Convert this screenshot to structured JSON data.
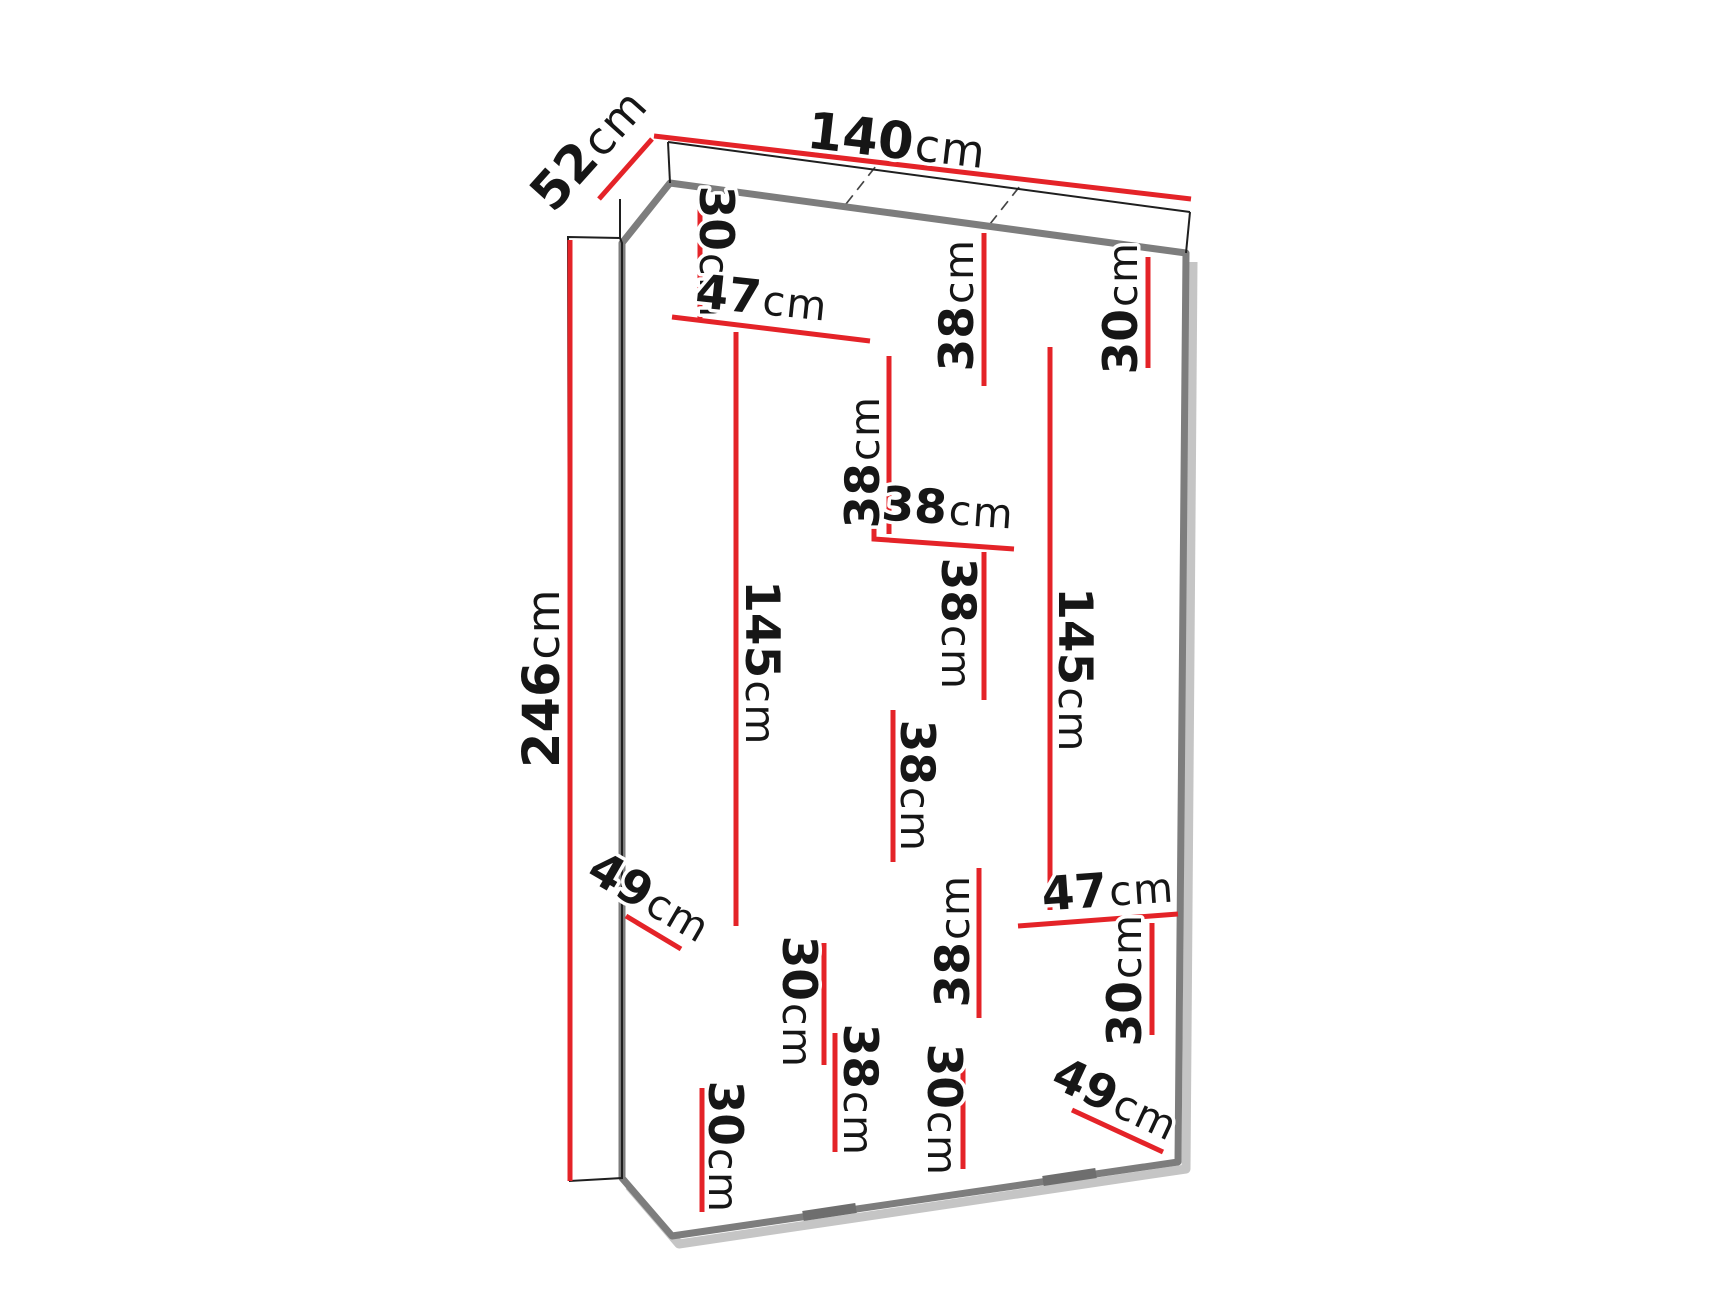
{
  "diagram": {
    "type": "furniture-dimension-drawing",
    "subject": "three-door wardrobe with interior shelving, front perspective view",
    "units": "cm",
    "overall": {
      "width": "140cm",
      "depth": "52cm",
      "height": "246cm"
    }
  },
  "colors": {
    "dimension_red": "#e42328",
    "outline_gray": "#7d7d7d",
    "dashed_gray": "#454545",
    "background": "#ffffff",
    "text": "#161616"
  },
  "dims": [
    {
      "name": "top-depth",
      "value": "52",
      "unit": "cm"
    },
    {
      "name": "top-width",
      "value": "140",
      "unit": "cm"
    },
    {
      "name": "overall-height",
      "value": "246",
      "unit": "cm"
    },
    {
      "name": "left-top-compartment-height",
      "value": "30",
      "unit": "cm"
    },
    {
      "name": "left-shelf-width",
      "value": "47",
      "unit": "cm"
    },
    {
      "name": "mid-top-compartment-height",
      "value": "38",
      "unit": "cm"
    },
    {
      "name": "right-top-compartment-height",
      "value": "30",
      "unit": "cm"
    },
    {
      "name": "mid-upper-compartment-height",
      "value": "38",
      "unit": "cm"
    },
    {
      "name": "mid-shelf-width",
      "value": "38",
      "unit": "cm"
    },
    {
      "name": "mid-middle-compartment-height",
      "value": "38",
      "unit": "cm"
    },
    {
      "name": "mid-lower-compartment-height",
      "value": "38",
      "unit": "cm"
    },
    {
      "name": "mid-lower2-compartment-height",
      "value": "38",
      "unit": "cm"
    },
    {
      "name": "left-lower-compartment-height",
      "value": "30",
      "unit": "cm"
    },
    {
      "name": "left-bottom-compartment-height",
      "value": "30",
      "unit": "cm"
    },
    {
      "name": "mid-bottom-compartment-height",
      "value": "30",
      "unit": "cm"
    },
    {
      "name": "mid-bottom-left-compartment-height",
      "value": "38",
      "unit": "cm"
    },
    {
      "name": "left-hanging-space-height",
      "value": "145",
      "unit": "cm"
    },
    {
      "name": "right-hanging-space-height",
      "value": "145",
      "unit": "cm"
    },
    {
      "name": "right-shelf-width",
      "value": "47",
      "unit": "cm"
    },
    {
      "name": "right-lower-compartment-height",
      "value": "30",
      "unit": "cm"
    },
    {
      "name": "left-shelf-depth",
      "value": "49",
      "unit": "cm"
    },
    {
      "name": "right-shelf-depth",
      "value": "49",
      "unit": "cm"
    }
  ]
}
